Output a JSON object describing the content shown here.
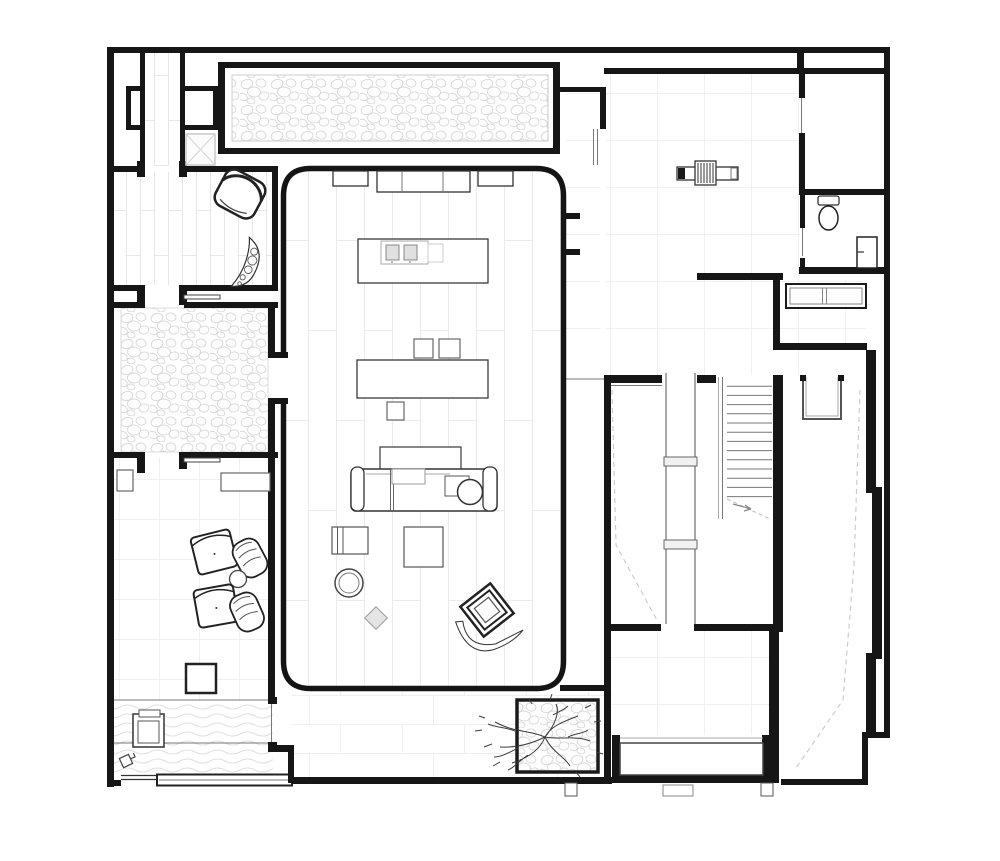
{
  "document": {
    "kind": "architectural-floor-plan",
    "view": "ground-floor-plan",
    "style": "black-ink line drawing on white, no text labels"
  },
  "canvas": {
    "width": 1000,
    "height": 861
  },
  "colors": {
    "background": "#ffffff",
    "wall": "#161616",
    "ink": "#333333",
    "mid": "#777777",
    "light": "#aaaaaa",
    "dash": "#cccccc",
    "floor_line": "#ececec",
    "pattern_stroke": "#d8d8d8",
    "soft_fill": "#e4e4e4"
  },
  "rooms": [
    "entry-hall",
    "storage-room",
    "wc",
    "great-room",
    "kitchen-area",
    "dining-area",
    "living-area",
    "lounge",
    "gravel-courtyard",
    "sitting-room",
    "water-feature",
    "terrace",
    "porch",
    "stair-hall",
    "ramp-corridor",
    "gravel-strip",
    "tree-planter",
    "entry-cross-passage"
  ],
  "floor_patterns": {
    "great_room": "wide-plank-wood",
    "lounge": "narrow-plank-wood",
    "entry_hall": "large-square-tile",
    "sitting_room": "medium-square-tile",
    "terrace": "stone-coursing",
    "courtyard": "pebbles",
    "gravel_strip": "pebbles",
    "water_feature": "waves"
  },
  "stairs": {
    "treads": 13,
    "bridges_over_void": 2,
    "ramp_paths_dashed": 2
  },
  "fixtures": {
    "kitchen_island_burners": 2,
    "dining_chairs": 3,
    "sofa_seats": 3,
    "armchair_ottoman_sets": 2,
    "toilet": 1,
    "sink": 1,
    "hall_bench": 1,
    "wardrobe_niches": 3,
    "cabinets": 3,
    "tree": 1,
    "skylight": 1
  },
  "icons": [
    "faucet-icon",
    "skylight-x-icon",
    "stair-direction-arrow-icon"
  ]
}
